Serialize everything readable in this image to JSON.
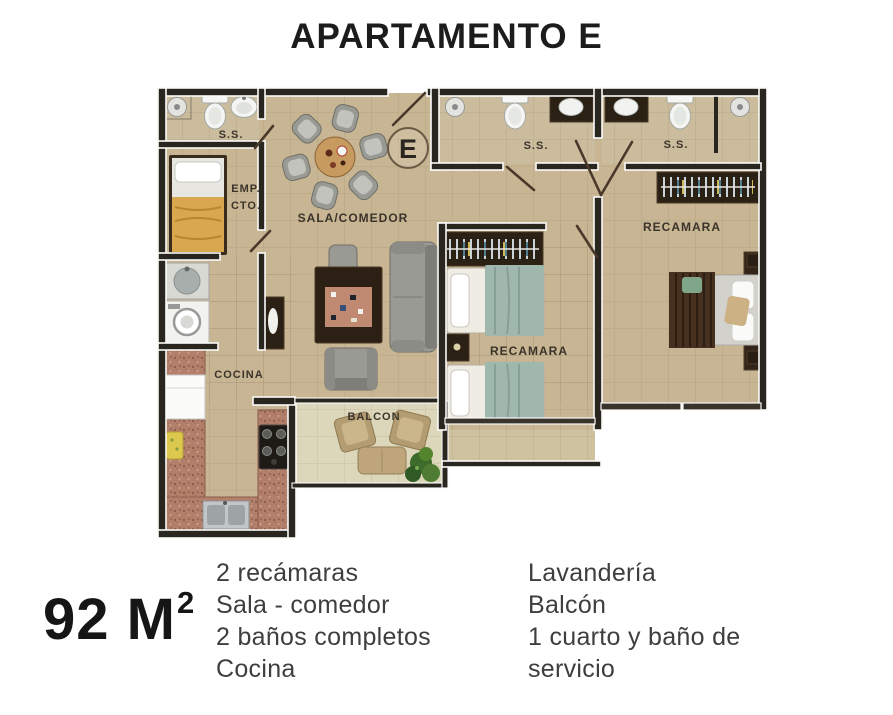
{
  "title": "APARTAMENTO E",
  "area": {
    "value": "92 M",
    "sup": "2"
  },
  "features": {
    "col1": [
      "2 recámaras",
      "Sala - comedor",
      "2 baños completos",
      "Cocina"
    ],
    "col2": [
      "Lavandería",
      "Balcón",
      "1 cuarto y baño de servicio"
    ]
  },
  "plan": {
    "unit": "E",
    "labels": {
      "bathroom1": "S.S.",
      "bathroom2": "S.S.",
      "bathroom3": "S.S.",
      "service_room_line1": "EMP.",
      "service_room_line2": "CTO.",
      "living_dining": "SALA/COMEDOR",
      "bedroom_middle": "RECAMARA",
      "bedroom_right": "RECAMARA",
      "kitchen": "COCINA",
      "balcony": "BALCON"
    }
  },
  "colors": {
    "wall": "#29251f",
    "floor": "#c7b593",
    "floor-bath": "#cbbc9e",
    "floor-balcony": "#dcd6ba",
    "floor-ledge": "#cec29f",
    "counter": "#b27f6b",
    "accent-teal": "#a0b7ad",
    "accent-yellow": "#d9a74e",
    "text-dark": "#1c1c1c",
    "text-body": "#3e3e3e",
    "label": "#3b342a"
  }
}
